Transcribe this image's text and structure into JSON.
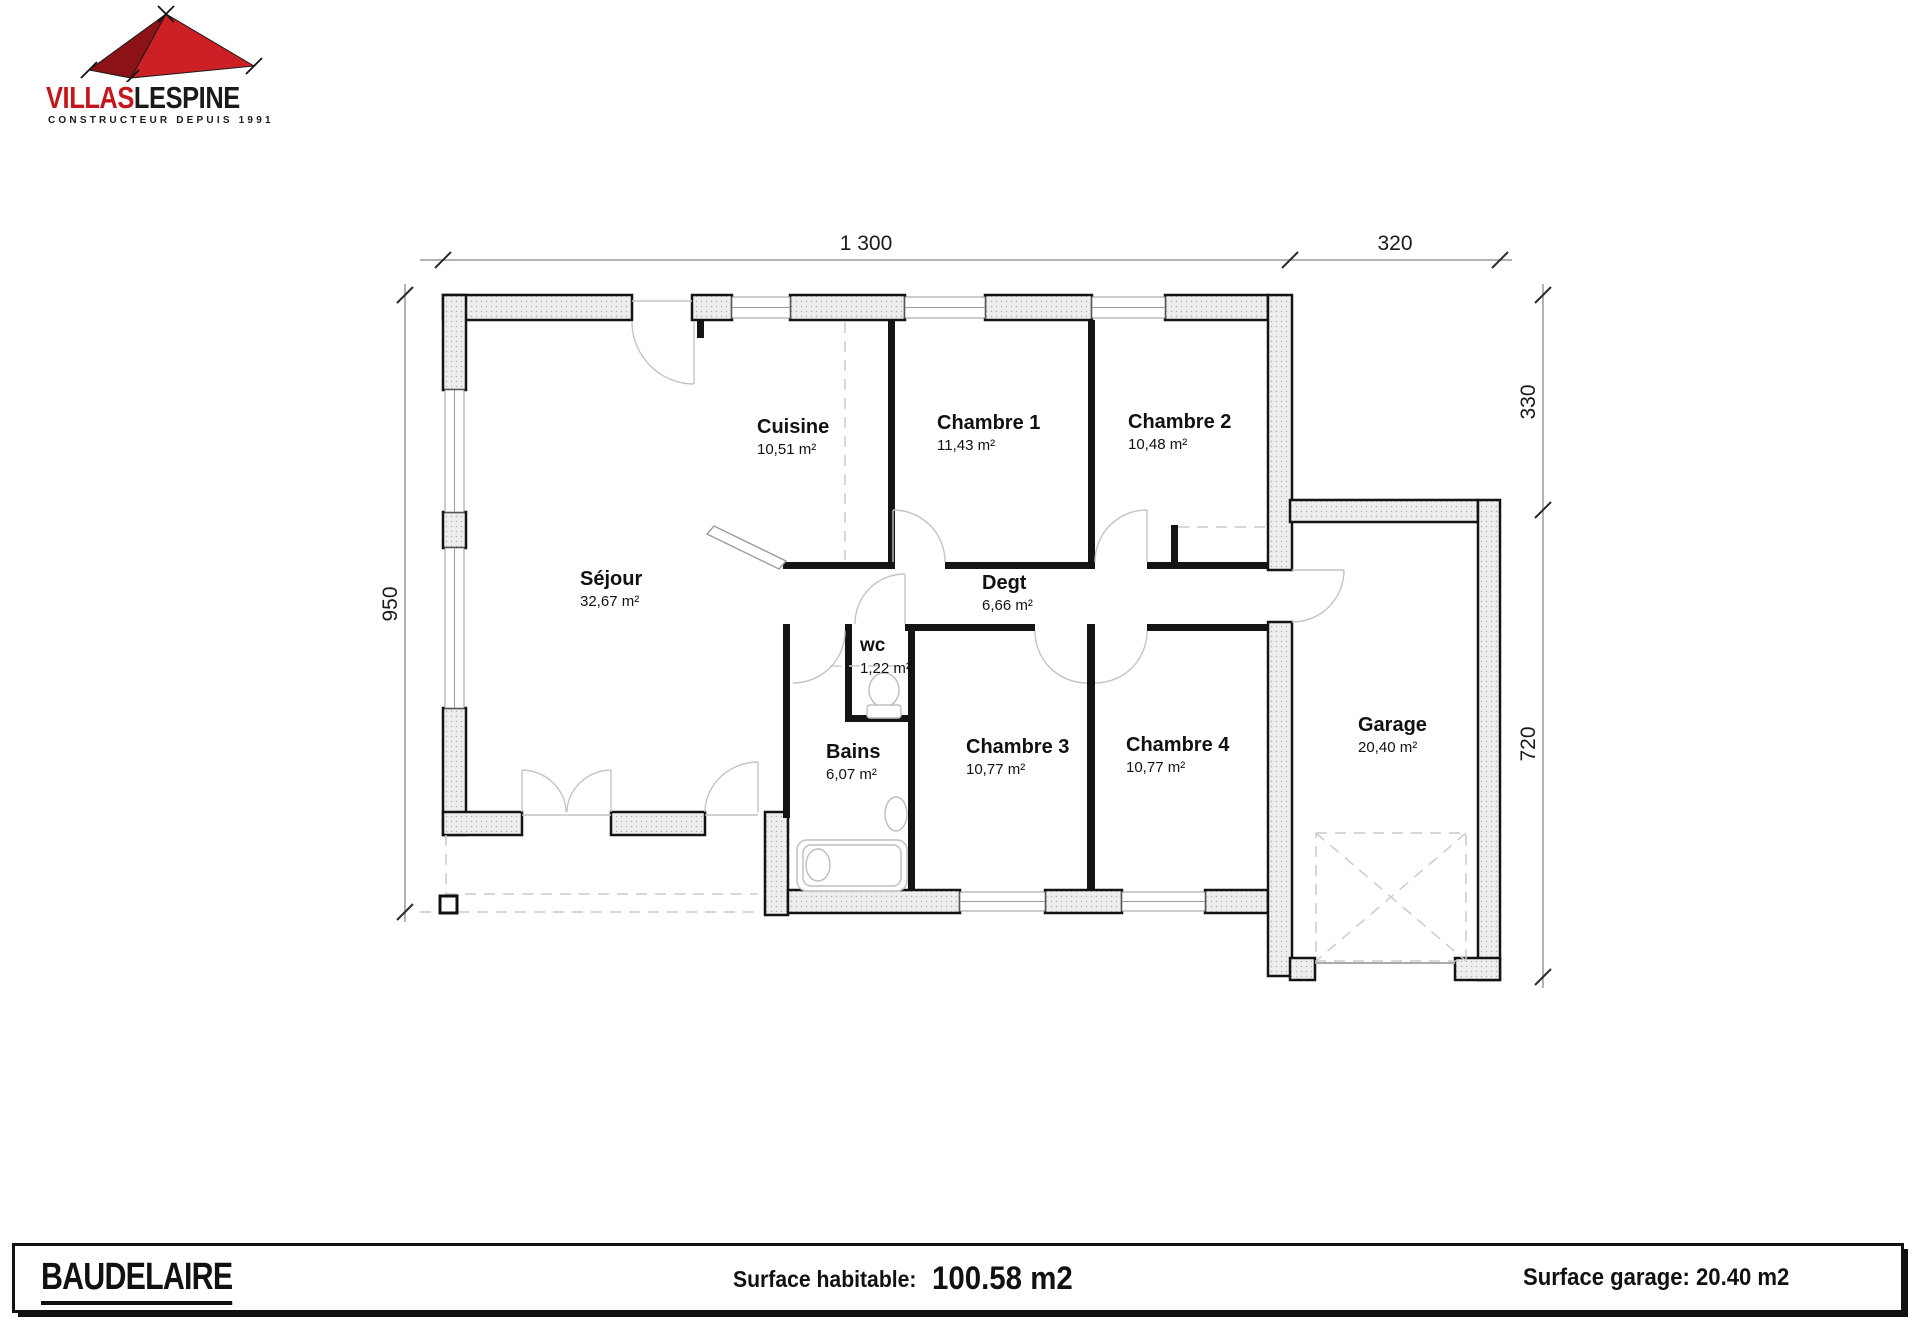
{
  "logo": {
    "brand_primary": "VILLAS",
    "brand_secondary": "LESPINE",
    "tagline": "CONSTRUCTEUR DEPUIS 1991"
  },
  "plan": {
    "rooms": {
      "sejour": {
        "name": "Séjour",
        "area": "32,67 m²"
      },
      "cuisine": {
        "name": "Cuisine",
        "area": "10,51 m²"
      },
      "chambre1": {
        "name": "Chambre 1",
        "area": "11,43 m²"
      },
      "chambre2": {
        "name": "Chambre 2",
        "area": "10,48 m²"
      },
      "degt": {
        "name": "Degt",
        "area": "6,66 m²"
      },
      "wc": {
        "name": "wc",
        "area": "1,22 m²"
      },
      "bains": {
        "name": "Bains",
        "area": "6,07 m²"
      },
      "chambre3": {
        "name": "Chambre 3",
        "area": "10,77 m²"
      },
      "chambre4": {
        "name": "Chambre 4",
        "area": "10,77 m²"
      },
      "garage": {
        "name": "Garage",
        "area": "20,40 m²"
      }
    },
    "dimensions": {
      "width_main": "1 300",
      "width_garage": "320",
      "height_left": "950",
      "height_right_top": "330",
      "height_right_bottom": "720"
    }
  },
  "footer": {
    "model_name": "BAUDELAIRE",
    "habitable_label": "Surface habitable: ",
    "habitable_value": "100.58 m2",
    "garage_text": "Surface garage: 20.40 m2"
  },
  "colors": {
    "brand_red": "#c4161d",
    "wall_black": "#141414"
  }
}
